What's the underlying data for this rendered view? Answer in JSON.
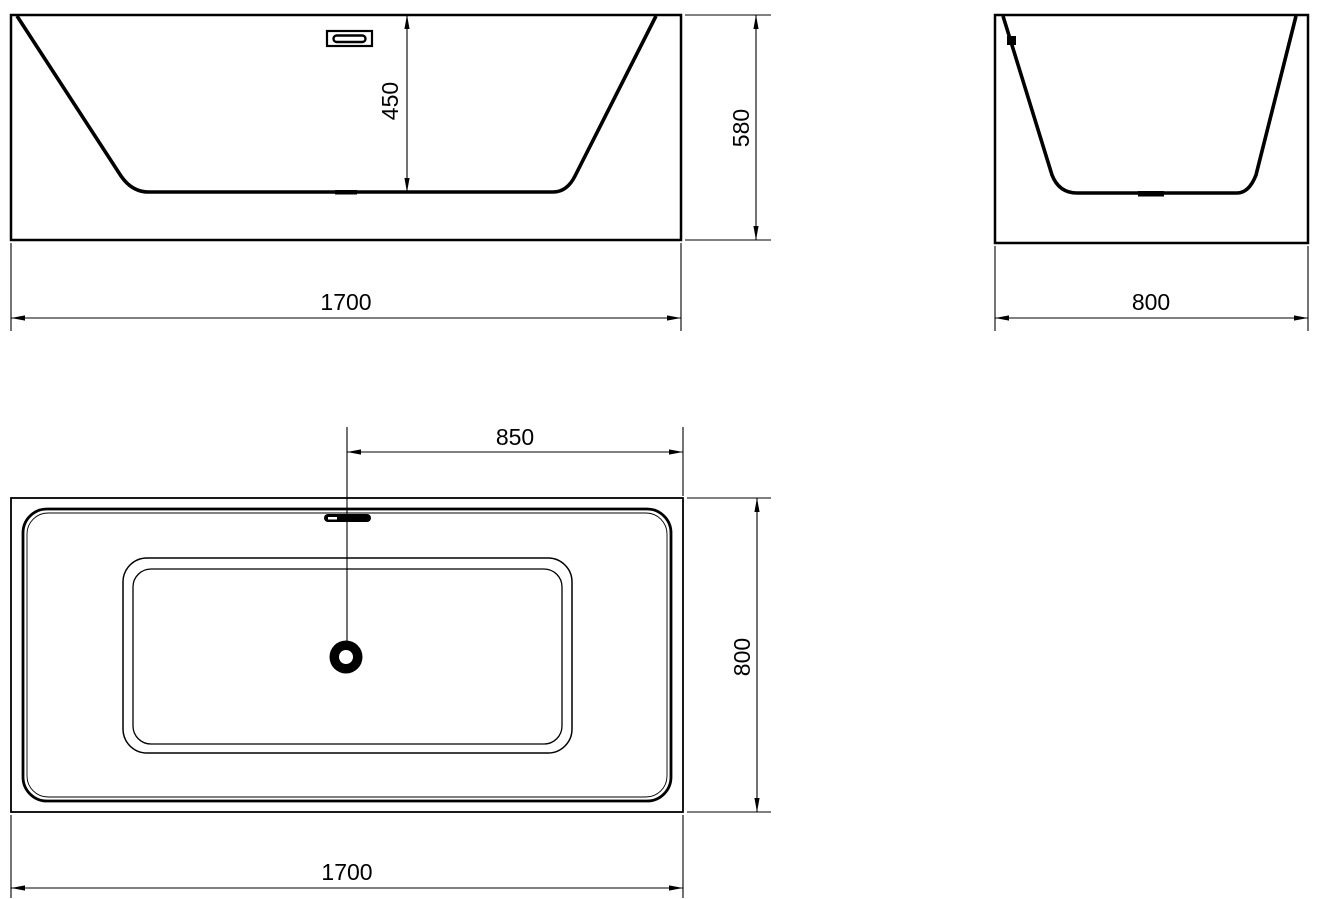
{
  "drawing": {
    "type": "technical-orthographic-views",
    "subject": "rectangular freestanding bathtub",
    "colors": {
      "line": "#000000",
      "background": "#ffffff"
    },
    "views": {
      "front": {
        "dimensions": {
          "inner_depth": "450",
          "overall_height": "580",
          "overall_length": "1700"
        }
      },
      "side": {
        "dimensions": {
          "overall_width": "800"
        }
      },
      "plan": {
        "dimensions": {
          "drain_center_offset": "850",
          "overall_width": "800",
          "overall_length": "1700"
        }
      }
    }
  }
}
